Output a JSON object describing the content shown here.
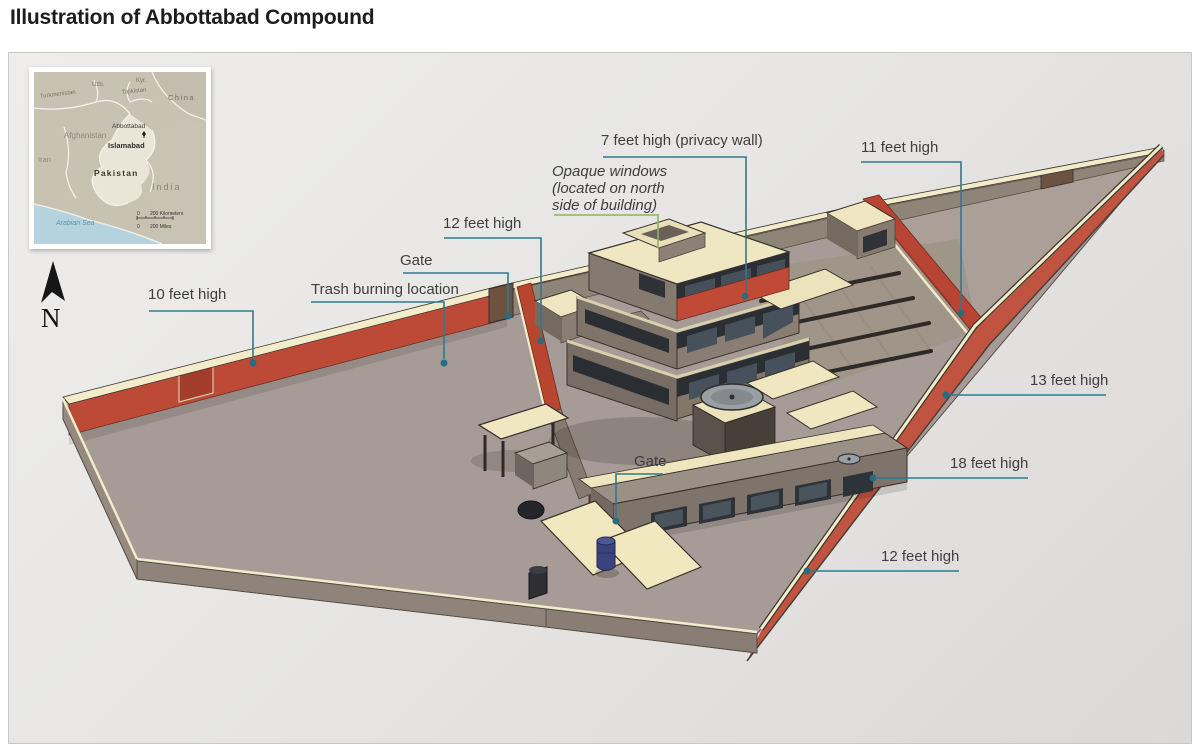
{
  "page": {
    "title": "Illustration of Abbottabad Compound"
  },
  "inset_map": {
    "labels": {
      "turkmenistan": "Turkmenistan",
      "uzb": "Uzb.",
      "kyr": "Kyr.",
      "tajikistan": "Tajikistan",
      "china": "China",
      "afghanistan": "Afghanistan",
      "iran": "Iran",
      "pakistan": "Pakistan",
      "india": "India",
      "abbottabad": "Abbottabad",
      "islamabad": "Islamabad",
      "arabian_sea": "Arabian Sea",
      "scale_km_zero": "0",
      "scale_km": "200 Kilometers",
      "scale_mi_zero": "0",
      "scale_mi": "200 Miles"
    }
  },
  "compass": {
    "north_label": "N"
  },
  "annotations": {
    "wall_10ft": "10 feet high",
    "trash": "Trash burning location",
    "gate_north": "Gate",
    "wall_12ft": "12 feet high",
    "privacy_wall": "7 feet high (privacy wall)",
    "opaque_line1": "Opaque windows",
    "opaque_line2": "(located on north",
    "opaque_line3": "side of building)",
    "wall_11ft": "11 feet high",
    "wall_13ft": "13 feet high",
    "wall_18ft": "18 feet high",
    "wall_12ft_south": "12 feet high",
    "gate_south": "Gate"
  },
  "colors": {
    "leader_teal": "#2e7a8e",
    "leader_green": "#86b95a",
    "wall_red": "#bd4a36",
    "wall_red_bright": "#c05440",
    "privacy_red": "#c04a36",
    "wall_top_cream": "#f2ecca",
    "roof_cream": "#efe7c2",
    "ground_gray": "#a69b96",
    "building_gray": "#857a70",
    "window_dark": "#2b2f34",
    "gate_brown": "#6e5140",
    "barrel_blue": "#3a4380",
    "map_sea": "#b5d3df",
    "map_land": "#c8c2b2",
    "map_highlight": "#eae6d7"
  }
}
